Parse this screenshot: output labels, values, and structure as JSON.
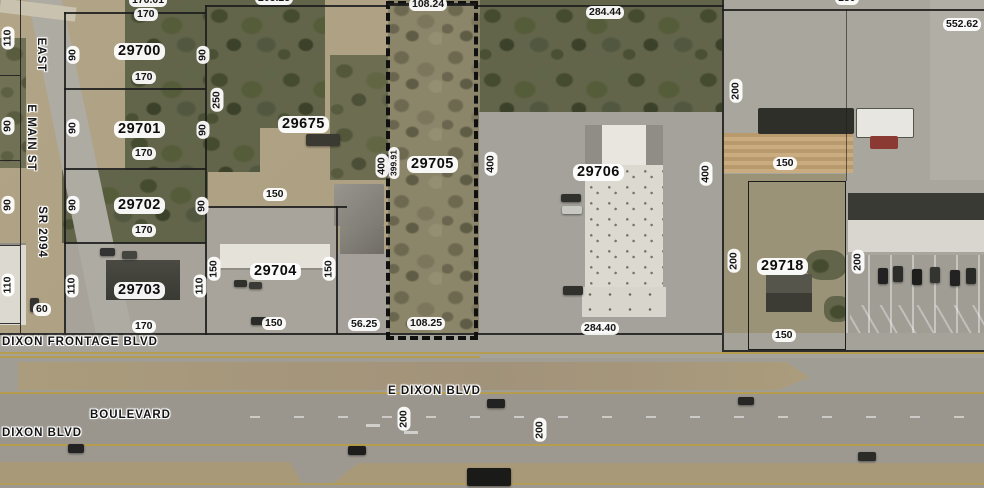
{
  "map": {
    "description": "County GIS parcel viewer over aerial imagery",
    "colors": {
      "parcel_line": "#1c1c1c",
      "selection_dash": "#101010",
      "label_bg": "#ffffff",
      "label_text": "#141414",
      "road_yellow": "#b59c4e"
    },
    "labels_h": [
      {
        "kind": "dim",
        "text": "170.01",
        "x": 129,
        "y": -6
      },
      {
        "kind": "dim",
        "text": "170",
        "x": 134,
        "y": 8
      },
      {
        "kind": "parcel",
        "text": "29700",
        "x": 114,
        "y": 43
      },
      {
        "kind": "dim",
        "text": "170",
        "x": 132,
        "y": 71
      },
      {
        "kind": "parcel",
        "text": "29701",
        "x": 114,
        "y": 121
      },
      {
        "kind": "dim",
        "text": "170",
        "x": 132,
        "y": 147
      },
      {
        "kind": "parcel",
        "text": "29702",
        "x": 114,
        "y": 197
      },
      {
        "kind": "dim",
        "text": "170",
        "x": 132,
        "y": 224
      },
      {
        "kind": "parcel",
        "text": "29703",
        "x": 114,
        "y": 282
      },
      {
        "kind": "dim",
        "text": "170",
        "x": 132,
        "y": 320
      },
      {
        "kind": "dim",
        "text": "60",
        "x": 33,
        "y": 303
      },
      {
        "kind": "dim",
        "text": "150",
        "x": 263,
        "y": 188
      },
      {
        "kind": "parcel",
        "text": "29704",
        "x": 250,
        "y": 263
      },
      {
        "kind": "dim",
        "text": "150",
        "x": 262,
        "y": 317
      },
      {
        "kind": "dim",
        "text": "56.25",
        "x": 348,
        "y": 318
      },
      {
        "kind": "dim",
        "text": "108.25",
        "x": 407,
        "y": 317
      },
      {
        "kind": "dim",
        "text": "108.24",
        "x": 409,
        "y": -2
      },
      {
        "kind": "dim",
        "text": "205.25",
        "x": 255,
        "y": -8
      },
      {
        "kind": "parcel",
        "text": "29675",
        "x": 278,
        "y": 116
      },
      {
        "kind": "parcel",
        "text": "29705",
        "x": 407,
        "y": 156
      },
      {
        "kind": "dim",
        "text": "284.44",
        "x": 586,
        "y": 6
      },
      {
        "kind": "parcel",
        "text": "29706",
        "x": 573,
        "y": 164
      },
      {
        "kind": "dim",
        "text": "284.40",
        "x": 581,
        "y": 322
      },
      {
        "kind": "dim",
        "text": "552.62",
        "x": 943,
        "y": 18
      },
      {
        "kind": "dim",
        "text": "150",
        "x": 773,
        "y": 157
      },
      {
        "kind": "parcel",
        "text": "29718",
        "x": 757,
        "y": 258
      },
      {
        "kind": "dim",
        "text": "150",
        "x": 772,
        "y": 329
      },
      {
        "kind": "dim",
        "text": "150",
        "x": 835,
        "y": -8
      },
      {
        "kind": "road",
        "text": "DIXON FRONTAGE BLVD",
        "x": 2,
        "y": 336
      },
      {
        "kind": "road",
        "text": "BOULEVARD",
        "x": 90,
        "y": 409
      },
      {
        "kind": "road",
        "text": "DIXON BLVD",
        "x": 2,
        "y": 427
      },
      {
        "kind": "road",
        "text": "E DIXON BLVD",
        "x": 388,
        "y": 385
      }
    ],
    "labels_v": [
      {
        "kind": "dim",
        "text": "110",
        "cx": 8,
        "cy": 38
      },
      {
        "kind": "dim",
        "text": "90",
        "cx": 73,
        "cy": 55
      },
      {
        "kind": "dim",
        "text": "90",
        "cx": 203,
        "cy": 55
      },
      {
        "kind": "dim",
        "text": "250",
        "cx": 217,
        "cy": 100
      },
      {
        "kind": "dim",
        "text": "90",
        "cx": 8,
        "cy": 126
      },
      {
        "kind": "dim",
        "text": "90",
        "cx": 73,
        "cy": 128
      },
      {
        "kind": "dim",
        "text": "90",
        "cx": 203,
        "cy": 130
      },
      {
        "kind": "dim",
        "text": "90",
        "cx": 8,
        "cy": 205
      },
      {
        "kind": "dim",
        "text": "90",
        "cx": 73,
        "cy": 205
      },
      {
        "kind": "dim",
        "text": "90",
        "cx": 202,
        "cy": 206
      },
      {
        "kind": "dim",
        "text": "110",
        "cx": 8,
        "cy": 285
      },
      {
        "kind": "dim",
        "text": "110",
        "cx": 72,
        "cy": 286
      },
      {
        "kind": "dim",
        "text": "110",
        "cx": 200,
        "cy": 286
      },
      {
        "kind": "dim",
        "text": "150",
        "cx": 214,
        "cy": 269
      },
      {
        "kind": "dim",
        "text": "150",
        "cx": 329,
        "cy": 269
      },
      {
        "kind": "dim",
        "text": "400",
        "cx": 382,
        "cy": 166
      },
      {
        "kind": "dimsm",
        "text": "399.91",
        "cx": 394,
        "cy": 163
      },
      {
        "kind": "dim",
        "text": "400",
        "cx": 491,
        "cy": 164
      },
      {
        "kind": "dim",
        "text": "400",
        "cx": 706,
        "cy": 174
      },
      {
        "kind": "dim",
        "text": "200",
        "cx": 736,
        "cy": 91
      },
      {
        "kind": "dim",
        "text": "200",
        "cx": 734,
        "cy": 261
      },
      {
        "kind": "dim",
        "text": "200",
        "cx": 858,
        "cy": 262
      },
      {
        "kind": "dim",
        "text": "200",
        "cx": 404,
        "cy": 419
      },
      {
        "kind": "dim",
        "text": "200",
        "cx": 540,
        "cy": 430
      },
      {
        "kind": "roadv",
        "text": "EAST",
        "cx": 41,
        "cy": 55
      },
      {
        "kind": "roadv",
        "text": "E MAIN ST",
        "cx": 31,
        "cy": 138
      },
      {
        "kind": "roadv",
        "text": "SR 2094",
        "cx": 42,
        "cy": 232
      }
    ]
  }
}
